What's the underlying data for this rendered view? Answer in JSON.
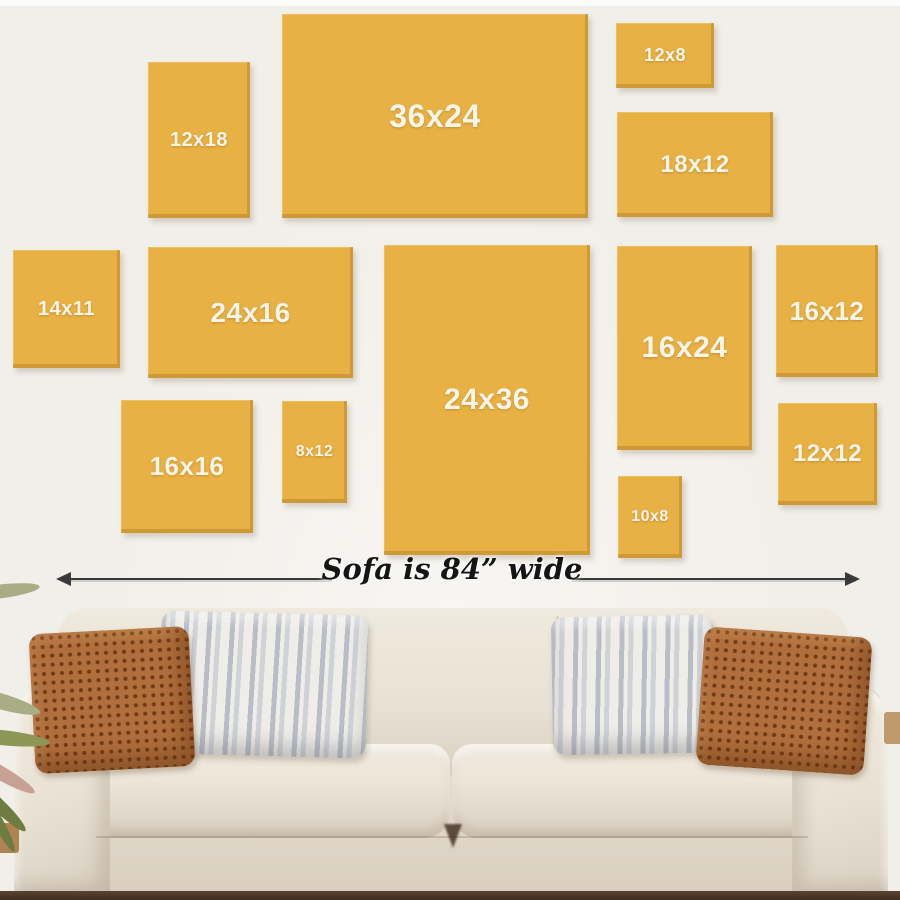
{
  "theme": {
    "wall": "#f1efe9",
    "canvas_fill": "#e8b144",
    "canvas_label": "#faf5ea",
    "arrow": "#3a3a3a",
    "measure_text": "#151515",
    "floor": "#3f2d1f",
    "sofa_light": "#f0eade",
    "sofa_mid": "#e6ded1",
    "sofa_dark": "#d8cfc0",
    "rust": "#b06f3d",
    "rust_dot": "#713a15",
    "stripe_a": "#b9bec6",
    "stripe_b": "#efede8",
    "leaf_olive": "#8c9655",
    "leaf_sage": "#a8ad85",
    "leaf_dark": "#6e7c41",
    "leaf_pink": "#c7a194",
    "wood": "#b08352"
  },
  "canvases": [
    {
      "label": "12x18",
      "x": 148,
      "y": 62,
      "w": 102,
      "h": 156,
      "fs": 20
    },
    {
      "label": "36x24",
      "x": 282,
      "y": 14,
      "w": 306,
      "h": 204,
      "fs": 32
    },
    {
      "label": "12x8",
      "x": 616,
      "y": 23,
      "w": 98,
      "h": 65,
      "fs": 18
    },
    {
      "label": "18x12",
      "x": 617,
      "y": 112,
      "w": 156,
      "h": 105,
      "fs": 24
    },
    {
      "label": "14x11",
      "x": 13,
      "y": 250,
      "w": 107,
      "h": 118,
      "fs": 20
    },
    {
      "label": "24x16",
      "x": 148,
      "y": 247,
      "w": 205,
      "h": 131,
      "fs": 28
    },
    {
      "label": "24x36",
      "x": 384,
      "y": 245,
      "w": 206,
      "h": 310,
      "fs": 30
    },
    {
      "label": "16x24",
      "x": 617,
      "y": 246,
      "w": 135,
      "h": 204,
      "fs": 30
    },
    {
      "label": "16x12",
      "x": 776,
      "y": 245,
      "w": 102,
      "h": 132,
      "fs": 26
    },
    {
      "label": "16x16",
      "x": 121,
      "y": 400,
      "w": 132,
      "h": 133,
      "fs": 26
    },
    {
      "label": "8x12",
      "x": 282,
      "y": 401,
      "w": 65,
      "h": 102,
      "fs": 16
    },
    {
      "label": "12x12",
      "x": 778,
      "y": 403,
      "w": 99,
      "h": 102,
      "fs": 24
    },
    {
      "label": "10x8",
      "x": 618,
      "y": 476,
      "w": 64,
      "h": 82,
      "fs": 16
    }
  ],
  "measure": {
    "text": "Sofa is 84” wide"
  }
}
